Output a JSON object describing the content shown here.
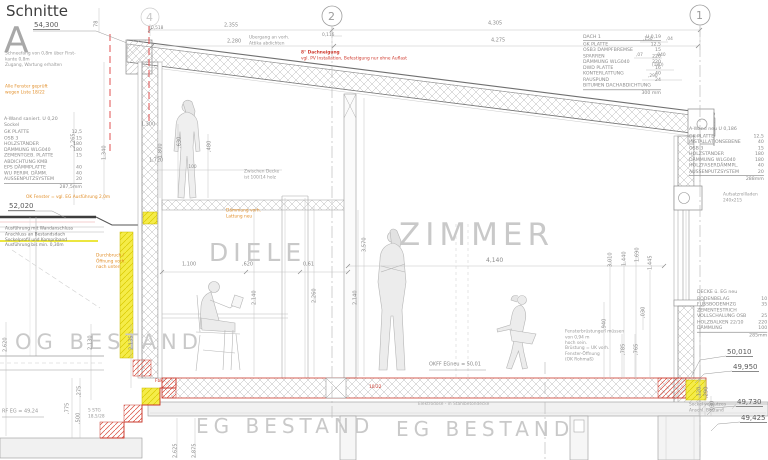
{
  "colors": {
    "red": "#cf3a2e",
    "orange": "#e2902c",
    "yellow": "#f5ec49",
    "line_gray": "#9a9a9a"
  },
  "header": {
    "title": "Schnitte",
    "letter": "A"
  },
  "grid": {
    "b4": "4",
    "b2": "2",
    "b1": "1"
  },
  "rooms": {
    "diele": "DIELE",
    "zimmer": "ZIMMER",
    "og": "OG BESTAND",
    "eg_a": "EG BESTAND",
    "eg_b": "EG BESTAND"
  },
  "levels": {
    "ridge": "54,300",
    "roof_og": "52,020",
    "r1": "50,010",
    "r2": "49,950",
    "r3": "49,730",
    "r4": "49,425",
    "okff": "OKFF EGneu = 50,01",
    "rfeg": "RF EG = 49,24"
  },
  "dims": {
    "t1": "2,355",
    "t2": "2,280",
    "t3": "4,305",
    "t4": "4,275",
    "t5": "0,518",
    "t6": "0,116",
    "rs1": ",150",
    "rs2": ",04",
    "rs3": ",07",
    "rs4": ",040",
    "rs5": "(180)",
    "rs6": ",290",
    "lv0": "78",
    "lv1": "2,265",
    "lv2": "1,340",
    "lh1": "1,300",
    "lv3": "1,800",
    "lv4": ",630",
    "lv5": ",480",
    "lh2": "1,720",
    "lh3": ",100",
    "m1": "1,100",
    "m2": ",620",
    "m3": "0,61",
    "m4": "2,140",
    "m5": "2,260",
    "m6": "2,140",
    "m7": "3,570",
    "m8": "4,140",
    "rv1": "3,010",
    "rv2": "1,440",
    "rv3": "1,690",
    "rv4": "1,445",
    "rv5": ",940",
    "rv6": ",030",
    "rv7": ",785",
    "rv8": ",765",
    "ov1": "2,620",
    "ov2": "2,130",
    "ov3": "2,135",
    "sv1": ",275",
    "sv2": ",775",
    "sv3": ",500",
    "ev1": "2,625",
    "ev2": "2,875",
    "fv1": ",120",
    "fv2": ",290",
    "fv3": ",030"
  },
  "stairs_note": [
    "5 STG",
    "18,5/28"
  ],
  "roof_note": {
    "l1": "8° Dachneigung",
    "l2": "vgl. PV Installation, Befestigung nur ohne Auflast"
  },
  "notes": {
    "top_attika": [
      "Übergang an vorh.",
      "Attika abdichten"
    ],
    "left_gray": [
      "Schneefang von 0,8m über First-",
      "kante 0,8m",
      "Zugang, Wartung erhalten"
    ],
    "left_orange": [
      "Alle Fenster geprüft",
      "wegen Liste 18/22"
    ],
    "left_black": [
      "Ausführung mit Wandanschluss",
      "Anschluss an Bestandsdach",
      "Sockelprofil und Kompriband",
      "Ausführung bis min. 0,30m"
    ],
    "ok_fenster": "OK Fenster = vgl. EG Ausführung 2,0m",
    "durchbruch": [
      "Durchbruch /",
      "Öffnung vorh.",
      "nach unten"
    ],
    "zwischen": [
      "Zwischen Decke",
      "ist 100/14 holz"
    ],
    "daemmung": [
      "Dämmung vorh.",
      "Lattung neu"
    ],
    "fenster": [
      "Fensterbrüstungen müssen",
      "von 0,94 m",
      "hoch sein.",
      "Brüstung = UK vorh.",
      "Fenster-Öffnung",
      "(OK Rohmaß)"
    ],
    "elektro": "Elektrodose - in Stahlbetondecke",
    "rolladen": [
      "Aufsatzrollladen",
      "240x215"
    ],
    "right_small": [
      "Sockel verputzen",
      "Anschl. Bestand"
    ],
    "floor_red": "10/22",
    "fbk": "Fbk"
  },
  "legends": {
    "roof": {
      "h1": "DACH 1",
      "h2": "U 0,19",
      "total": "300 mm",
      "rows": [
        {
          "t": "GK PLATTE",
          "v": "12,5"
        },
        {
          "t": "OSB3 DAMPFBREMSE",
          "v": "15"
        },
        {
          "t": "SPARREN",
          "v": "220"
        },
        {
          "t": "DÄMMUNG WLG040",
          "v": "220"
        },
        {
          "t": "DWD PLATTE",
          "v": "16"
        },
        {
          "t": "KONTERLATTUNG",
          "v": "40"
        },
        {
          "t": "RAUSPUND",
          "v": "24"
        },
        {
          "t": "BITUMEN DACHABDICHTUNG",
          "v": ""
        }
      ]
    },
    "wall_left": {
      "h1": "A-Wand saniert. U 0,20",
      "h2": "Sockel",
      "total": "287,5mm",
      "rows": [
        {
          "t": "GK PLATTE",
          "v": "12,5"
        },
        {
          "t": "OSB 3",
          "v": "15"
        },
        {
          "t": "HOLZSTÄNDER",
          "v": "180"
        },
        {
          "t": "DÄMMUNG WLG040",
          "v": "180"
        },
        {
          "t": "ZEMENTGEB. PLATTE",
          "v": "15"
        },
        {
          "t": "ABDICHTUNG KMB",
          "v": ""
        },
        {
          "t": "EPS DÄMMPLATTE",
          "v": "40"
        },
        {
          "t": "WU PERIM. DÄMM.",
          "v": "40"
        },
        {
          "t": "AUSSENPUTZSYSTEM",
          "v": "20"
        }
      ]
    },
    "wall_right": {
      "h1": "A-Wand neu U 0,186",
      "total": "288mm",
      "rows": [
        {
          "t": "GK PLATTE",
          "v": "12,5"
        },
        {
          "t": "INSTALLATIONSEBENE",
          "v": "40"
        },
        {
          "t": "OSB 3",
          "v": "15"
        },
        {
          "t": "HOLZSTÄNDER",
          "v": "180"
        },
        {
          "t": "DÄMMUNG WLG040",
          "v": "180"
        },
        {
          "t": "HOLZFASERDÄMMPL.",
          "v": "40"
        },
        {
          "t": "AUSSENPUTZSYSTEM",
          "v": "20"
        }
      ]
    },
    "ceiling": {
      "h1": "DECKE ü. EG neu",
      "total": "285mm",
      "rows": [
        {
          "t": "BODENBELAG",
          "v": "10"
        },
        {
          "t": "FUSSBODENHZG",
          "v": "35"
        },
        {
          "t": "ZEMENTESTRICH",
          "v": ""
        },
        {
          "t": "VOLLSCHALUNG OSB",
          "v": "25"
        },
        {
          "t": "HOLZBALKEN 22/10",
          "v": "220"
        },
        {
          "t": "DÄMMUNG",
          "v": "100"
        }
      ]
    }
  }
}
